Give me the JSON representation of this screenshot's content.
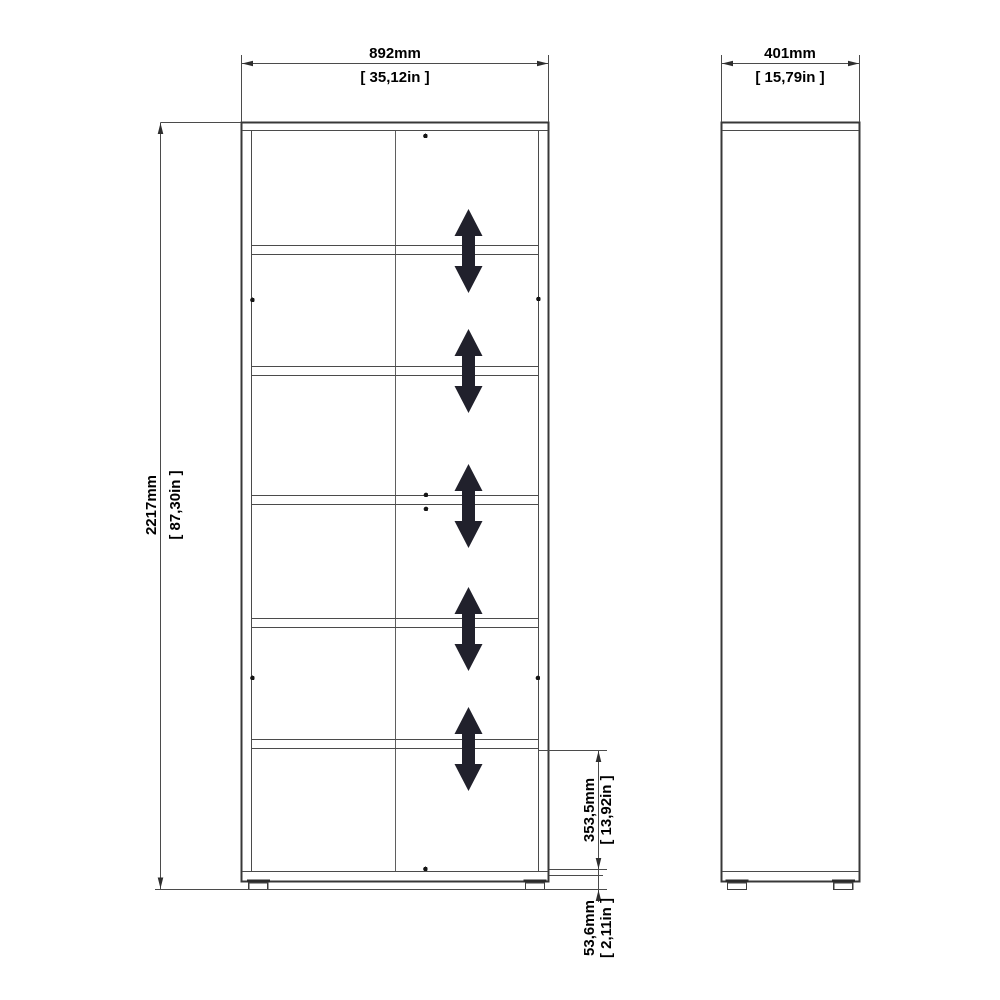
{
  "drawing": {
    "kind": "furniture dimension drawing",
    "views": [
      "front",
      "side"
    ]
  },
  "dimensions": {
    "width": {
      "mm": "892mm",
      "inches": "[ 35,12in ]"
    },
    "depth": {
      "mm": "401mm",
      "inches": "[ 15,79in ]"
    },
    "height": {
      "mm": "2217mm",
      "inches": "[ 87,30in ]"
    },
    "shelf_spacing": {
      "mm": "353,5mm",
      "inches": "[ 13,92in ]"
    },
    "foot_height": {
      "mm": "53,6mm",
      "inches": "[ 2,11in ]"
    }
  },
  "counts": {
    "shelves": 5,
    "adjustable_shelf_arrows": 5,
    "feet_per_view": 2,
    "fitting_dots": 8
  },
  "colors": {
    "background": "#ffffff",
    "outline": "#383838",
    "line": "#4b4b4b",
    "text": "#000000",
    "arrow": "#21212c"
  },
  "icons": {
    "adjustable_arrow": "double-headed-vertical-arrow"
  }
}
